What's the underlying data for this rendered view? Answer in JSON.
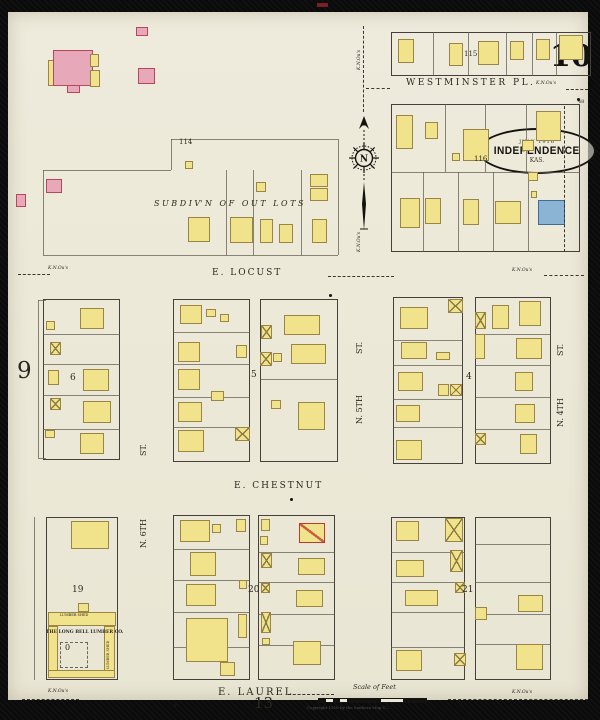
{
  "page": {
    "sheet_number": "10",
    "adjacent_left": "9",
    "adjacent_bottom": "13",
    "scale_label": "Scale of Feet",
    "copyright": "Copyright 1916 by the Sanborn Map Co.",
    "title": {
      "date": "JULY 1916",
      "city": "INDEPENDENCE",
      "state": "KAS."
    },
    "compass_letter": "N"
  },
  "colors": {
    "paper": "#edeadb",
    "building_yellow": "#f1e28c",
    "building_pink": "#e7a9ba",
    "building_blue": "#8ab3d4",
    "special_red": "#c0392b",
    "line": "#45413a",
    "background": "#0b0b0b"
  },
  "labels": [
    {
      "t": "WESTMINSTER PL.",
      "x": 398,
      "y": 67,
      "s": 9,
      "ls": 2.5
    },
    {
      "t": "E. LOCUST",
      "x": 204,
      "y": 257,
      "s": 9,
      "ls": 2
    },
    {
      "t": "E. CHESTNUT",
      "x": 226,
      "y": 470,
      "s": 9,
      "ls": 2
    },
    {
      "t": "E. LAUREL",
      "x": 210,
      "y": 676,
      "s": 10,
      "ls": 2
    },
    {
      "t": "N. 5TH",
      "x": 348,
      "y": 412,
      "s": 8,
      "r": 1
    },
    {
      "t": "ST.",
      "x": 348,
      "y": 342,
      "s": 8,
      "r": 1
    },
    {
      "t": "N. 4TH",
      "x": 549,
      "y": 415,
      "s": 8,
      "r": 1
    },
    {
      "t": "ST.",
      "x": 549,
      "y": 344,
      "s": 8,
      "r": 1
    },
    {
      "t": "N. 6TH",
      "x": 132,
      "y": 536,
      "s": 8,
      "r": 1
    },
    {
      "t": "ST.",
      "x": 132,
      "y": 444,
      "s": 8,
      "r": 1
    },
    {
      "t": "115",
      "x": 456,
      "y": 39,
      "s": 7
    },
    {
      "t": "116",
      "x": 466,
      "y": 144,
      "s": 7
    },
    {
      "t": "114",
      "x": 171,
      "y": 127,
      "s": 7
    },
    {
      "t": "5",
      "x": 243,
      "y": 359,
      "s": 9
    },
    {
      "t": "4",
      "x": 458,
      "y": 361,
      "s": 9
    },
    {
      "t": "6",
      "x": 62,
      "y": 362,
      "s": 9
    },
    {
      "t": "19",
      "x": 64,
      "y": 574,
      "s": 9
    },
    {
      "t": "20",
      "x": 240,
      "y": 574,
      "s": 9
    },
    {
      "t": "21",
      "x": 454,
      "y": 574,
      "s": 9
    },
    {
      "t": "48",
      "x": 570,
      "y": 88,
      "s": 5
    },
    {
      "t": "S U B D I V' N   O F   O U T   L O T S",
      "x": 146,
      "y": 188,
      "s": 8,
      "i": 1
    },
    {
      "t": "K.N.Ou's",
      "x": 528,
      "y": 70,
      "s": 4.5,
      "i": 1
    },
    {
      "t": "K.N.Ou's",
      "x": 40,
      "y": 255,
      "s": 4.5,
      "i": 1
    },
    {
      "t": "K.N.Ou's",
      "x": 504,
      "y": 257,
      "s": 4.5,
      "i": 1
    },
    {
      "t": "K.N.Ou's",
      "x": 40,
      "y": 678,
      "s": 4.5,
      "i": 1
    },
    {
      "t": "K.N.Ou's",
      "x": 504,
      "y": 679,
      "s": 4.5,
      "i": 1
    },
    {
      "t": "K.N.Ou's",
      "x": 350,
      "y": 58,
      "s": 4.5,
      "r": 1,
      "i": 1
    },
    {
      "t": "K.N.Ou's",
      "x": 350,
      "y": 240,
      "s": 4.5,
      "r": 1,
      "i": 1
    },
    {
      "t": "THE LONG BELL LUMBER CO.",
      "x": 38,
      "y": 619,
      "s": 4.5,
      "b": 1
    },
    {
      "t": "LUMBER SHED",
      "x": 52,
      "y": 602,
      "s": 3.5
    },
    {
      "t": "LUMBER SHED",
      "x": 99,
      "y": 657,
      "s": 3.5,
      "r": 1
    },
    {
      "t": "0",
      "x": 57,
      "y": 632,
      "s": 8
    }
  ],
  "geometry": {
    "blocks": [
      [
        383,
        20,
        200,
        44
      ],
      [
        383,
        92,
        189,
        148
      ],
      [
        35,
        287,
        77,
        161
      ],
      [
        165,
        287,
        77,
        163
      ],
      [
        252,
        287,
        78,
        163
      ],
      [
        385,
        285,
        70,
        167
      ],
      [
        467,
        285,
        76,
        167
      ],
      [
        38,
        505,
        72,
        163
      ],
      [
        165,
        503,
        77,
        165
      ],
      [
        250,
        503,
        77,
        165
      ],
      [
        383,
        505,
        74,
        163
      ],
      [
        467,
        505,
        76,
        163
      ]
    ],
    "lines": [
      [
        425,
        20,
        0,
        44
      ],
      [
        460,
        20,
        0,
        44
      ],
      [
        498,
        20,
        0,
        44
      ],
      [
        524,
        20,
        0,
        44
      ],
      [
        548,
        20,
        0,
        44
      ],
      [
        383,
        160,
        189,
        0
      ],
      [
        437,
        92,
        0,
        68
      ],
      [
        477,
        92,
        0,
        68
      ],
      [
        518,
        92,
        0,
        68
      ],
      [
        415,
        160,
        0,
        80
      ],
      [
        450,
        160,
        0,
        80
      ],
      [
        485,
        160,
        0,
        80
      ],
      [
        520,
        160,
        0,
        80
      ],
      [
        163,
        127,
        167,
        0
      ],
      [
        163,
        127,
        0,
        31
      ],
      [
        35,
        158,
        128,
        0
      ],
      [
        35,
        158,
        0,
        85
      ],
      [
        35,
        243,
        295,
        0
      ],
      [
        330,
        127,
        0,
        116
      ],
      [
        218,
        158,
        0,
        85
      ],
      [
        245,
        158,
        0,
        85
      ],
      [
        293,
        158,
        0,
        85
      ],
      [
        30,
        288,
        0,
        158
      ],
      [
        30,
        288,
        8,
        0
      ],
      [
        30,
        446,
        8,
        0
      ],
      [
        35,
        322,
        77,
        0
      ],
      [
        35,
        352,
        77,
        0
      ],
      [
        35,
        383,
        77,
        0
      ],
      [
        35,
        417,
        77,
        0
      ],
      [
        165,
        320,
        77,
        0
      ],
      [
        165,
        352,
        77,
        0
      ],
      [
        165,
        385,
        77,
        0
      ],
      [
        165,
        415,
        77,
        0
      ],
      [
        252,
        367,
        78,
        0
      ],
      [
        385,
        328,
        70,
        0
      ],
      [
        385,
        353,
        70,
        0
      ],
      [
        385,
        387,
        70,
        0
      ],
      [
        385,
        415,
        70,
        0
      ],
      [
        467,
        322,
        76,
        0
      ],
      [
        467,
        353,
        76,
        0
      ],
      [
        467,
        385,
        76,
        0
      ],
      [
        467,
        417,
        76,
        0
      ],
      [
        165,
        537,
        77,
        0
      ],
      [
        165,
        568,
        77,
        0
      ],
      [
        165,
        600,
        77,
        0
      ],
      [
        165,
        635,
        77,
        0
      ],
      [
        250,
        540,
        77,
        0
      ],
      [
        250,
        570,
        77,
        0
      ],
      [
        250,
        602,
        77,
        0
      ],
      [
        250,
        633,
        77,
        0
      ],
      [
        383,
        540,
        74,
        0
      ],
      [
        383,
        570,
        74,
        0
      ],
      [
        383,
        600,
        74,
        0
      ],
      [
        383,
        635,
        74,
        0
      ],
      [
        467,
        532,
        76,
        0
      ],
      [
        467,
        570,
        76,
        0
      ],
      [
        467,
        602,
        76,
        0
      ],
      [
        467,
        632,
        76,
        0
      ],
      [
        26,
        505,
        0,
        163
      ]
    ],
    "dashes": [
      [
        355,
        14,
        86,
        1
      ],
      [
        358,
        76,
        24,
        0
      ],
      [
        558,
        77,
        22,
        0
      ],
      [
        10,
        262,
        32,
        0
      ],
      [
        320,
        264,
        66,
        0
      ],
      [
        536,
        263,
        40,
        0
      ],
      [
        280,
        682,
        46,
        0
      ],
      [
        14,
        687,
        57,
        0
      ],
      [
        440,
        687,
        140,
        0
      ],
      [
        556,
        94,
        146,
        1
      ]
    ],
    "dash_rects": [
      [
        52,
        630,
        28,
        26
      ]
    ],
    "dots": [
      [
        570,
        87
      ],
      [
        322,
        283
      ],
      [
        378,
        695
      ],
      [
        167,
        693
      ],
      [
        283,
        487
      ]
    ],
    "scraps": [
      [
        317,
        3,
        11,
        4
      ]
    ],
    "buildings": [
      [
        40,
        48,
        9,
        26,
        "y"
      ],
      [
        45,
        38,
        40,
        36,
        "p"
      ],
      [
        82,
        42,
        9,
        13,
        "y"
      ],
      [
        82,
        58,
        10,
        17,
        "y"
      ],
      [
        59,
        73,
        13,
        8,
        "p"
      ],
      [
        128,
        15,
        12,
        9,
        "p"
      ],
      [
        130,
        56,
        17,
        16,
        "p"
      ],
      [
        38,
        167,
        16,
        14,
        "p"
      ],
      [
        8,
        182,
        10,
        13,
        "p"
      ],
      [
        177,
        149,
        8,
        8,
        "y"
      ],
      [
        390,
        27,
        16,
        24,
        "y"
      ],
      [
        441,
        31,
        14,
        23,
        "y"
      ],
      [
        470,
        29,
        21,
        24,
        "y"
      ],
      [
        502,
        29,
        14,
        19,
        "y"
      ],
      [
        528,
        27,
        14,
        21,
        "y"
      ],
      [
        551,
        23,
        24,
        25,
        "y"
      ],
      [
        388,
        103,
        17,
        34,
        "y"
      ],
      [
        417,
        110,
        13,
        17,
        "y"
      ],
      [
        455,
        117,
        26,
        32,
        "y"
      ],
      [
        444,
        141,
        8,
        8,
        "y"
      ],
      [
        528,
        99,
        25,
        30,
        "y"
      ],
      [
        514,
        128,
        12,
        11,
        "y"
      ],
      [
        520,
        160,
        10,
        9,
        "y"
      ],
      [
        523,
        179,
        6,
        7,
        "y"
      ],
      [
        392,
        186,
        20,
        30,
        "y"
      ],
      [
        417,
        186,
        16,
        26,
        "y"
      ],
      [
        455,
        187,
        16,
        26,
        "y"
      ],
      [
        487,
        189,
        26,
        23,
        "y"
      ],
      [
        530,
        188,
        27,
        25,
        "b"
      ],
      [
        180,
        205,
        22,
        25,
        "y"
      ],
      [
        222,
        205,
        23,
        26,
        "y"
      ],
      [
        252,
        207,
        13,
        24,
        "y"
      ],
      [
        271,
        212,
        14,
        19,
        "y"
      ],
      [
        302,
        162,
        18,
        13,
        "y"
      ],
      [
        302,
        176,
        18,
        13,
        "y"
      ],
      [
        304,
        207,
        15,
        24,
        "y"
      ],
      [
        248,
        170,
        10,
        10,
        "y"
      ],
      [
        72,
        296,
        24,
        21,
        "y"
      ],
      [
        38,
        309,
        9,
        9,
        "y"
      ],
      [
        42,
        330,
        11,
        13,
        "x"
      ],
      [
        75,
        357,
        26,
        22,
        "y"
      ],
      [
        40,
        358,
        11,
        15,
        "y"
      ],
      [
        42,
        386,
        11,
        12,
        "x"
      ],
      [
        75,
        389,
        28,
        22,
        "y"
      ],
      [
        37,
        418,
        10,
        8,
        "y"
      ],
      [
        72,
        421,
        24,
        21,
        "y"
      ],
      [
        172,
        293,
        22,
        19,
        "y"
      ],
      [
        198,
        297,
        10,
        8,
        "y"
      ],
      [
        212,
        302,
        9,
        8,
        "y"
      ],
      [
        170,
        330,
        22,
        20,
        "y"
      ],
      [
        228,
        333,
        11,
        13,
        "y"
      ],
      [
        170,
        357,
        22,
        21,
        "y"
      ],
      [
        203,
        379,
        13,
        10,
        "y"
      ],
      [
        170,
        390,
        24,
        20,
        "y"
      ],
      [
        170,
        418,
        26,
        22,
        "y"
      ],
      [
        227,
        415,
        15,
        14,
        "x"
      ],
      [
        253,
        313,
        11,
        14,
        "x"
      ],
      [
        252,
        340,
        12,
        14,
        "x"
      ],
      [
        276,
        303,
        36,
        20,
        "y"
      ],
      [
        283,
        332,
        35,
        20,
        "y"
      ],
      [
        265,
        341,
        9,
        9,
        "y"
      ],
      [
        263,
        388,
        10,
        9,
        "y"
      ],
      [
        290,
        390,
        27,
        28,
        "y"
      ],
      [
        392,
        295,
        28,
        22,
        "y"
      ],
      [
        440,
        287,
        15,
        14,
        "x"
      ],
      [
        393,
        330,
        26,
        17,
        "y"
      ],
      [
        428,
        340,
        14,
        8,
        "y"
      ],
      [
        390,
        360,
        25,
        19,
        "y"
      ],
      [
        430,
        372,
        11,
        12,
        "y"
      ],
      [
        442,
        372,
        12,
        12,
        "x"
      ],
      [
        388,
        393,
        24,
        17,
        "y"
      ],
      [
        388,
        428,
        26,
        20,
        "y"
      ],
      [
        467,
        300,
        11,
        17,
        "x"
      ],
      [
        484,
        293,
        17,
        24,
        "y"
      ],
      [
        511,
        289,
        22,
        25,
        "y"
      ],
      [
        467,
        322,
        10,
        25,
        "y"
      ],
      [
        508,
        326,
        26,
        21,
        "y"
      ],
      [
        507,
        360,
        18,
        19,
        "y"
      ],
      [
        507,
        392,
        20,
        19,
        "y"
      ],
      [
        467,
        421,
        11,
        12,
        "x"
      ],
      [
        512,
        422,
        17,
        20,
        "y"
      ],
      [
        63,
        509,
        38,
        28,
        "y"
      ],
      [
        70,
        591,
        11,
        9,
        "y"
      ],
      [
        40,
        600,
        68,
        14,
        "y"
      ],
      [
        40,
        614,
        10,
        50,
        "y"
      ],
      [
        96,
        614,
        11,
        48,
        "y"
      ],
      [
        40,
        658,
        67,
        8,
        "y"
      ],
      [
        172,
        508,
        30,
        22,
        "y"
      ],
      [
        204,
        512,
        9,
        9,
        "y"
      ],
      [
        228,
        507,
        10,
        13,
        "y"
      ],
      [
        182,
        540,
        26,
        24,
        "y"
      ],
      [
        178,
        572,
        30,
        22,
        "y"
      ],
      [
        231,
        568,
        8,
        9,
        "y"
      ],
      [
        178,
        606,
        42,
        44,
        "y"
      ],
      [
        230,
        602,
        9,
        24,
        "y"
      ],
      [
        212,
        650,
        15,
        14,
        "y"
      ],
      [
        253,
        507,
        9,
        12,
        "y"
      ],
      [
        252,
        524,
        8,
        9,
        "y"
      ],
      [
        291,
        511,
        26,
        20,
        "r"
      ],
      [
        253,
        541,
        11,
        15,
        "x"
      ],
      [
        290,
        546,
        27,
        17,
        "y"
      ],
      [
        253,
        571,
        9,
        10,
        "x"
      ],
      [
        288,
        578,
        27,
        17,
        "y"
      ],
      [
        253,
        600,
        10,
        21,
        "x"
      ],
      [
        254,
        626,
        8,
        7,
        "y"
      ],
      [
        285,
        629,
        28,
        24,
        "y"
      ],
      [
        388,
        509,
        23,
        20,
        "y"
      ],
      [
        437,
        506,
        18,
        24,
        "x"
      ],
      [
        388,
        548,
        28,
        17,
        "y"
      ],
      [
        442,
        538,
        13,
        22,
        "x"
      ],
      [
        397,
        578,
        33,
        16,
        "y"
      ],
      [
        447,
        570,
        10,
        11,
        "x"
      ],
      [
        388,
        638,
        26,
        21,
        "y"
      ],
      [
        446,
        641,
        12,
        13,
        "x"
      ],
      [
        510,
        583,
        25,
        17,
        "y"
      ],
      [
        467,
        595,
        12,
        13,
        "y"
      ],
      [
        508,
        632,
        27,
        26,
        "y"
      ]
    ]
  }
}
